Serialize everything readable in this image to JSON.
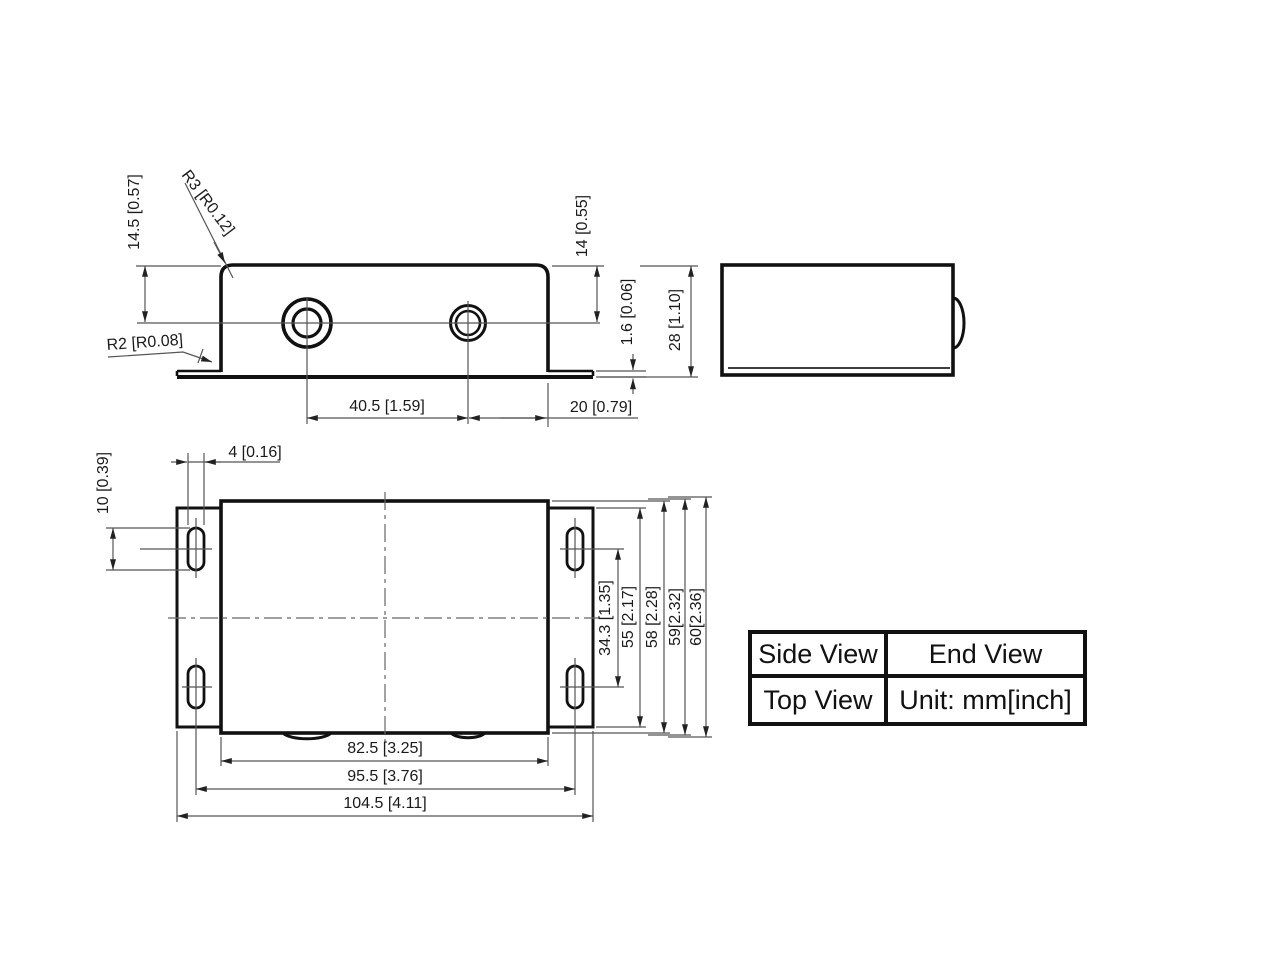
{
  "legend": {
    "side": "Side View",
    "end": "End View",
    "top": "Top View",
    "unit": "Unit: mm[inch]"
  },
  "side_view": {
    "dims": {
      "height_to_hole": "14.5 [0.57]",
      "corner_radius": "R3 [R0.12]",
      "bend_radius": "R2 [R0.08]",
      "top_to_hole": "14 [0.55]",
      "thickness": "1.6 [0.06]",
      "overall_height": "28 [1.10]",
      "hole_spacing": "40.5 [1.59]",
      "hole_to_edge": "20 [0.79]"
    }
  },
  "top_view": {
    "dims": {
      "slot_width": "4 [0.16]",
      "slot_length": "10 [0.39]",
      "slot_row_spacing": "34.3 [1.35]",
      "flange_depth": "55 [2.17]",
      "body_depth": "58 [2.28]",
      "depth_with_bend": "59[2.32]",
      "overall_depth": "60[2.36]",
      "body_length": "82.5 [3.25]",
      "slot_col_spacing": "95.5 [3.76]",
      "overall_length": "104.5 [4.11]"
    }
  }
}
